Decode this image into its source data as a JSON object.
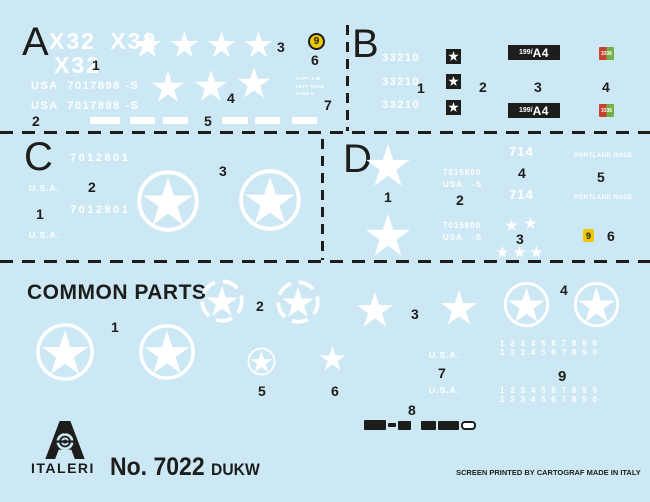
{
  "colors": {
    "sheet_background": "#cde8f5",
    "ink_black": "#1d1d1b",
    "decal_white": "#ffffff",
    "roundel_yellow": "#eec900",
    "flag_red": "#c8432e",
    "flag_green": "#74b043"
  },
  "a": {
    "label": "A",
    "x32_line1": "X32 X32",
    "x32_line2": "X32",
    "serial": "USA  7017898 -S",
    "stencil_line1": "CAPT 1 IN",
    "stencil_line2": "LEFT  GUAR",
    "stencil_line3": "DAVE S",
    "roundel_digit": "9",
    "n1": "1",
    "n2": "2",
    "n3": "3",
    "n4": "4",
    "n5": "5",
    "n6": "6",
    "n7": "7"
  },
  "b": {
    "label": "B",
    "serial": "33210",
    "plate_prefix": "199/",
    "plate_main": "A4",
    "flag_number": "3336",
    "n1": "1",
    "n2": "2",
    "n3": "3",
    "n4": "4"
  },
  "c": {
    "label": "C",
    "serial": "7012801",
    "usa": "U.S.A.",
    "n1": "1",
    "n2": "2",
    "n3": "3"
  },
  "d": {
    "label": "D",
    "serial_line1": "7015800",
    "serial_line2": "USA   -S",
    "unit": "714",
    "boat_name": "PORTLAND ROSE",
    "badge_digit": "9",
    "n1": "1",
    "n2": "2",
    "n3": "3",
    "n4": "4",
    "n5": "5",
    "n6": "6"
  },
  "cp": {
    "heading": "COMMON PARTS",
    "usa": "U.S.A.",
    "digits_row": "1 2 3 4 5 6 7 8 9 0",
    "n1": "1",
    "n2": "2",
    "n3": "3",
    "n4": "4",
    "n5": "5",
    "n6": "6",
    "n7": "7",
    "n8": "8",
    "n9": "9"
  },
  "footer": {
    "brand": "ITALERI",
    "kit_no": "No. 7022",
    "kit_name": "DUKW",
    "print_credit": "SCREEN PRINTED BY CARTOGRAF MADE IN ITALY"
  }
}
